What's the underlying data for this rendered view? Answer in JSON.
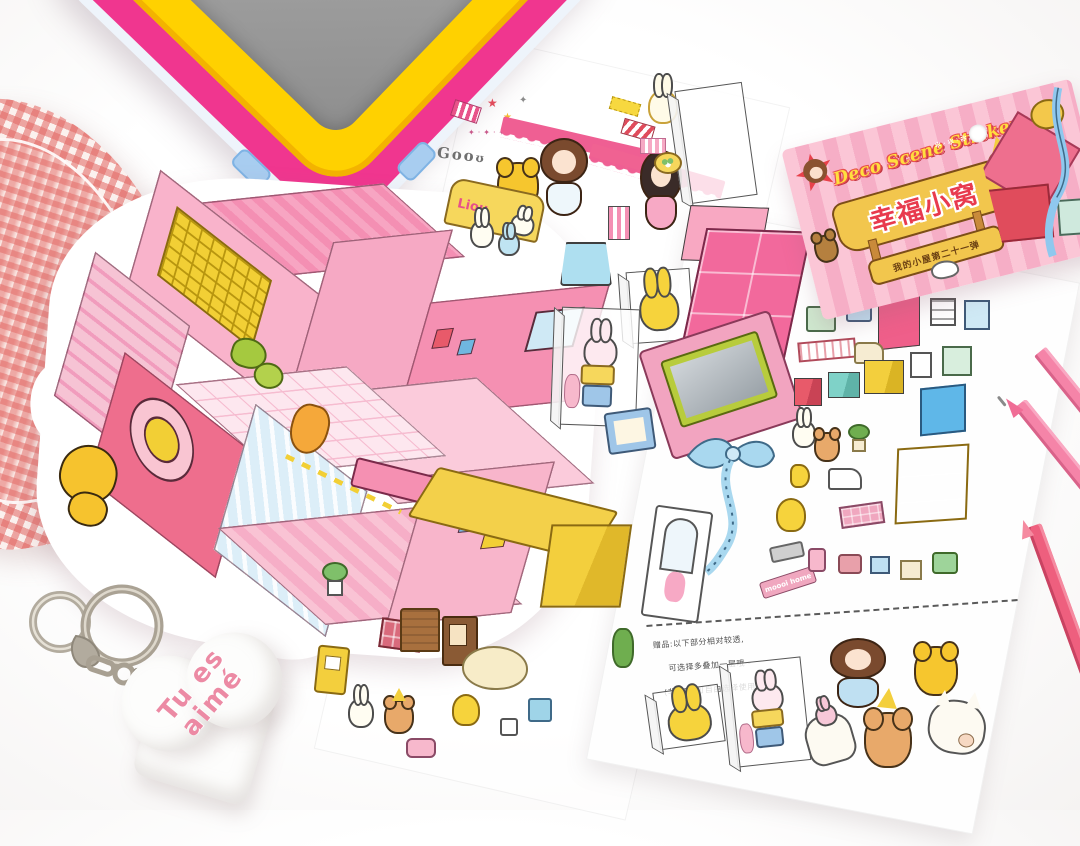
{
  "scene": {
    "kind": "product-photo-flatlay",
    "description": "Flat-lay photo of a kawaii deco sticker set: die-cut pink dollhouse scene card, two sticker sheets of miniature furniture and animal characters, pink striped header card, gingham heart fabric, lunch-box lid corner, two pink pens, a split-ring keychain and a white heart plush."
  },
  "package": {
    "script_text": "Deco Scene Stickers",
    "title": "幸福小窝",
    "series": "我的小屋第二十一弹"
  },
  "stickers": {
    "doodle_text": "Goo",
    "headboard_text": "Liou",
    "sign_text": "moooi home"
  },
  "note": {
    "line1": "赠品:以下部分相对较透,",
    "line2": "可选择多叠加一层哦~",
    "line3": "(非必须,可自由选择使用)"
  },
  "plush": {
    "line1": "Tu es",
    "line2": "aimé"
  },
  "colors": {
    "gingham_red": "#e26561",
    "lunchbox_yellow": "#ffd100",
    "lunchbox_magenta": "#f0368f",
    "lunchbox_clip_blue": "#a8cdf0",
    "house_pink": "#f6a9c4",
    "house_deep_pink": "#ee6e8d",
    "house_light_pink": "#fbd9e5",
    "accent_yellow": "#f3cf3d",
    "accent_green": "#a5c93f",
    "package_stripe_pink": "#f6aec6",
    "banner_yellow": "#f2c64d",
    "title_red": "#e83a4e",
    "pen_light_pink": "#f584a8",
    "pen_rose": "#ee5f7e",
    "metal_gray": "#aca594",
    "plush_text_pink": "#ec8aa4"
  },
  "objects": [
    "gingham-heart-fabric",
    "lunchbox-lid",
    "dollhouse-scene-card",
    "sticker-sheet-left",
    "sticker-sheet-right",
    "package-header-card",
    "pink-fineliner-pen",
    "rose-pen",
    "keychain-rings",
    "heart-plush"
  ]
}
